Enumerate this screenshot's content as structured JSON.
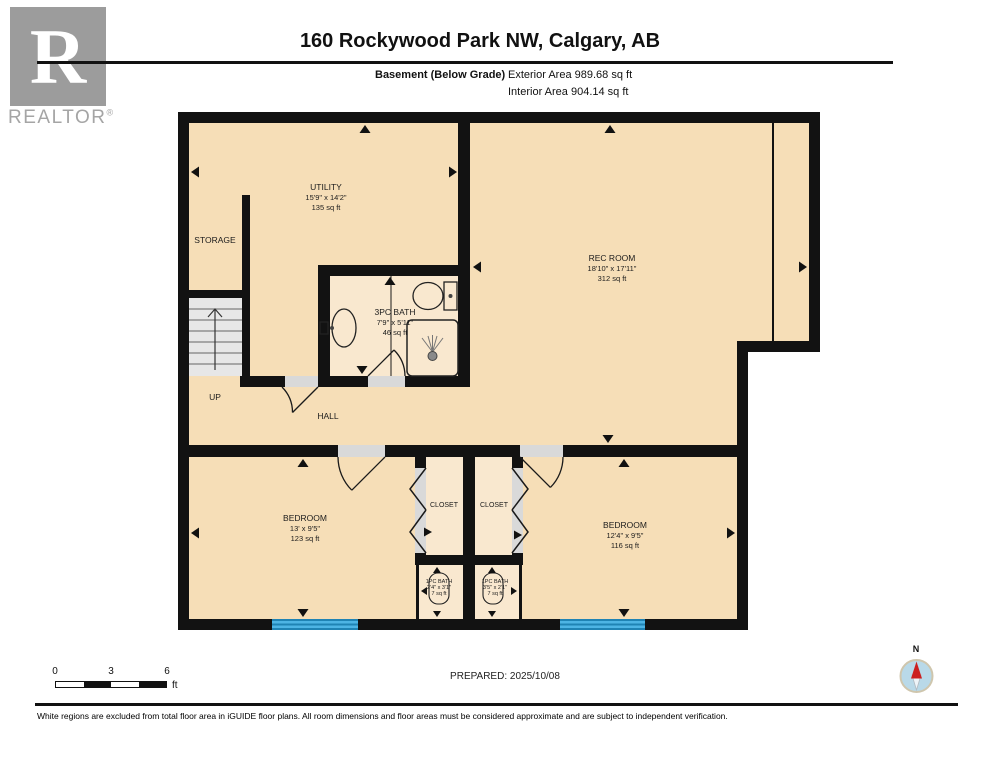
{
  "header": {
    "logo_letter": "R",
    "brand": "REALTOR",
    "brand_reg": "®",
    "title": "160 Rockywood Park NW, Calgary, AB",
    "floor_label": "Basement (Below Grade)",
    "exterior_area": "Exterior Area 989.68 sq ft",
    "interior_area": "Interior Area 904.14 sq ft"
  },
  "rooms": {
    "utility": {
      "name": "UTILITY",
      "dims": "15'9\" x 14'2\"",
      "area": "135 sq ft"
    },
    "storage": {
      "name": "STORAGE"
    },
    "rec_room": {
      "name": "REC ROOM",
      "dims": "18'10\" x 17'11\"",
      "area": "312 sq ft"
    },
    "bath_3pc": {
      "name": "3PC BATH",
      "dims": "7'9\" x 5'11\"",
      "area": "46 sq ft"
    },
    "hall": {
      "name": "HALL"
    },
    "stairs": {
      "label": "UP"
    },
    "bedroom_left": {
      "name": "BEDROOM",
      "dims": "13' x 9'5\"",
      "area": "123 sq ft"
    },
    "closet_left": {
      "name": "CLOSET"
    },
    "closet_right": {
      "name": "CLOSET"
    },
    "bedroom_right": {
      "name": "BEDROOM",
      "dims": "12'4\" x 9'5\"",
      "area": "116 sq ft"
    },
    "bath_1pc_left": {
      "name": "1PC BATH",
      "dims": "2'4\" x 3'1\"",
      "area": "7 sq ft"
    },
    "bath_1pc_right": {
      "name": "1PC BATH",
      "dims": "3'5\" x 2'1\"",
      "area": "7 sq ft"
    }
  },
  "footer": {
    "scale": {
      "zero": "0",
      "three": "3",
      "six": "6",
      "unit": "ft"
    },
    "prepared": "PREPARED: 2025/10/08",
    "compass_n": "N",
    "disclaimer": "White regions are excluded from total floor area in iGUIDE floor plans. All room dimensions and floor areas must be considered approximate and are subject to independent verification."
  },
  "colors": {
    "wall": "#121212",
    "floor": "#f6deb7",
    "floor_light": "#f9e8cf",
    "window_blue": "#45aedd",
    "compass_red": "#cc1f1f"
  }
}
